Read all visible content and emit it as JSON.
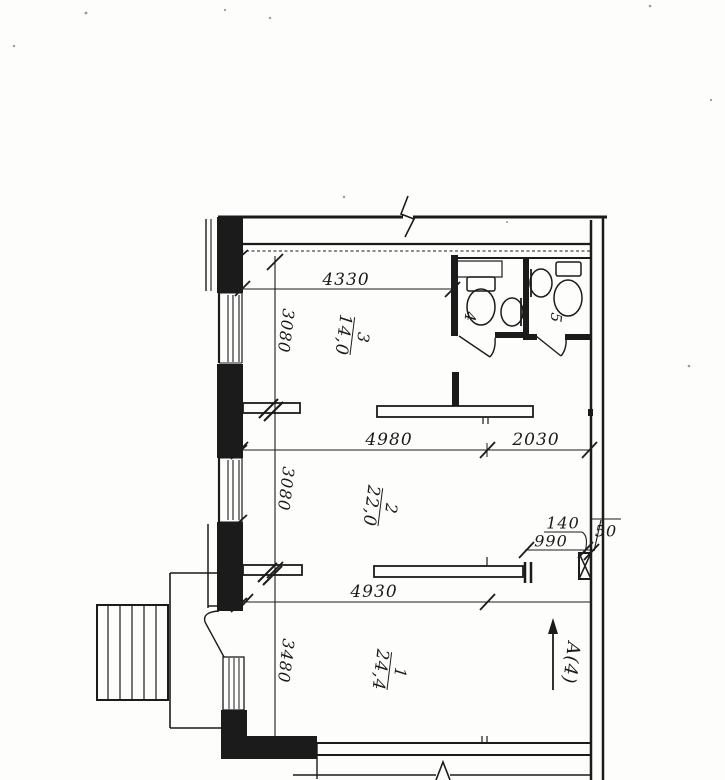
{
  "plan": {
    "rooms": [
      {
        "number": "3",
        "area": "14,0"
      },
      {
        "number": "2",
        "area": "22,0"
      },
      {
        "number": "1",
        "area": "24,4"
      },
      {
        "number": "4"
      },
      {
        "number": "5"
      }
    ],
    "dimensions": {
      "d4330": "4330",
      "d3080a": "3080",
      "d4980": "4980",
      "d2030": "2030",
      "d3080b": "3080",
      "d990": "990",
      "d140": "140",
      "d50": "50",
      "d4930": "4930",
      "d3480": "3480"
    },
    "section_marker": "A(4)",
    "ink": "#1b1b1b",
    "paper": "#fdfdfc"
  }
}
